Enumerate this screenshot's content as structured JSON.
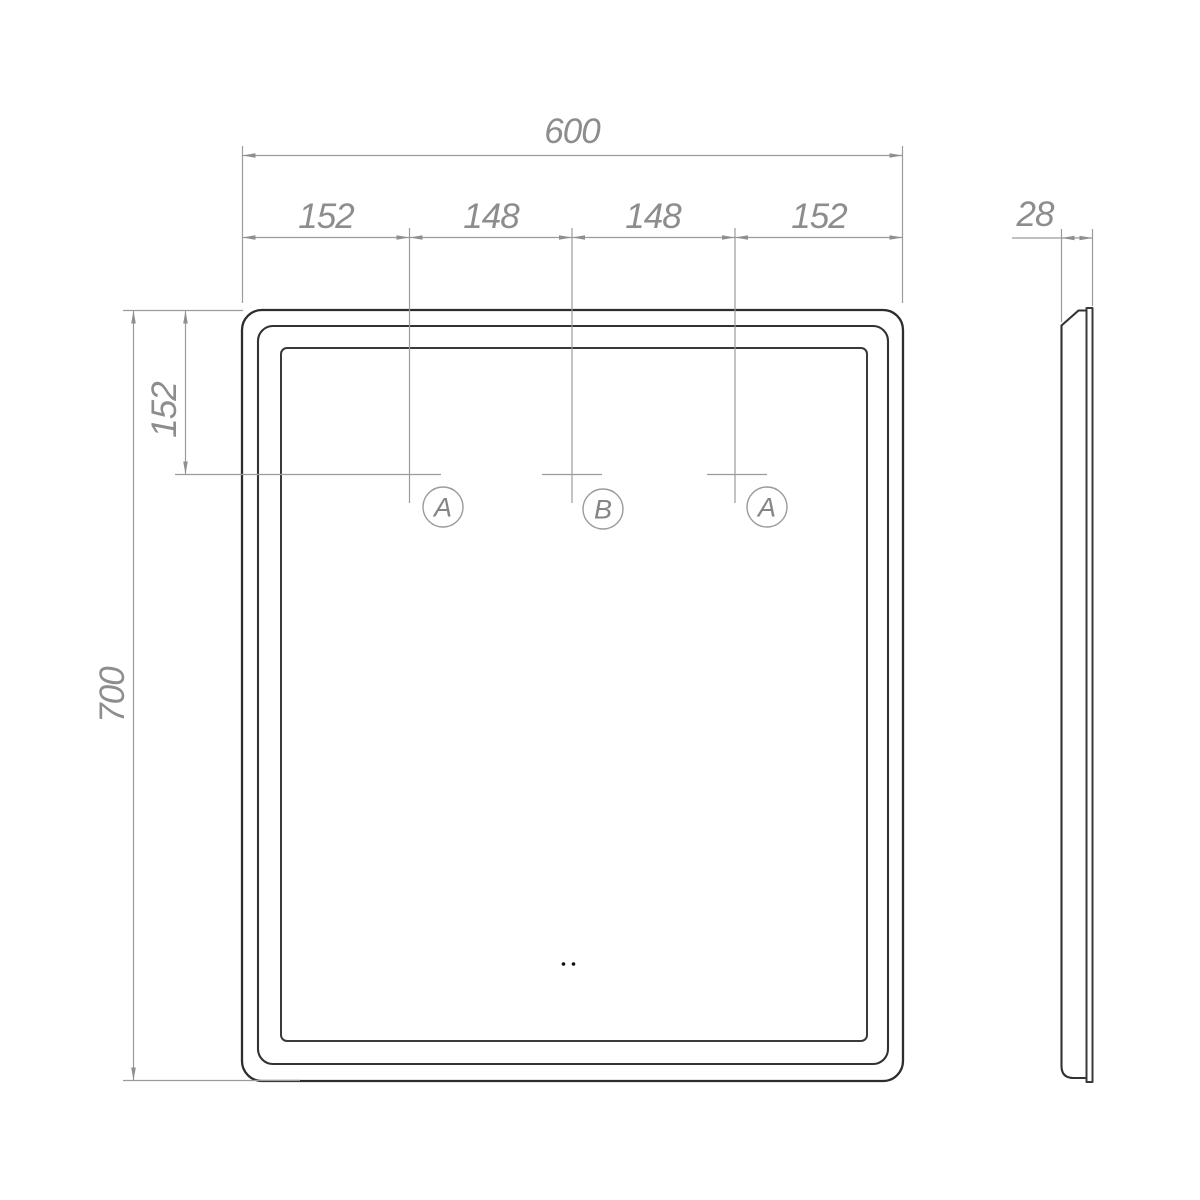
{
  "drawing": {
    "type": "technical-dimension-drawing",
    "subject": "rectangular mirror, front view and side profile view"
  },
  "colors": {
    "background": "#ffffff",
    "product_outline": "#2d2d2d",
    "dimension_lines": "#9b9b9b",
    "dimension_text": "#8d8d8d"
  },
  "front_view": {
    "overall_width": "600",
    "top_segments": [
      "152",
      "148",
      "148",
      "152"
    ],
    "overall_height": "700",
    "left_top_offset": "152",
    "markers": [
      "A",
      "B",
      "A"
    ]
  },
  "side_view": {
    "depth": "28"
  }
}
